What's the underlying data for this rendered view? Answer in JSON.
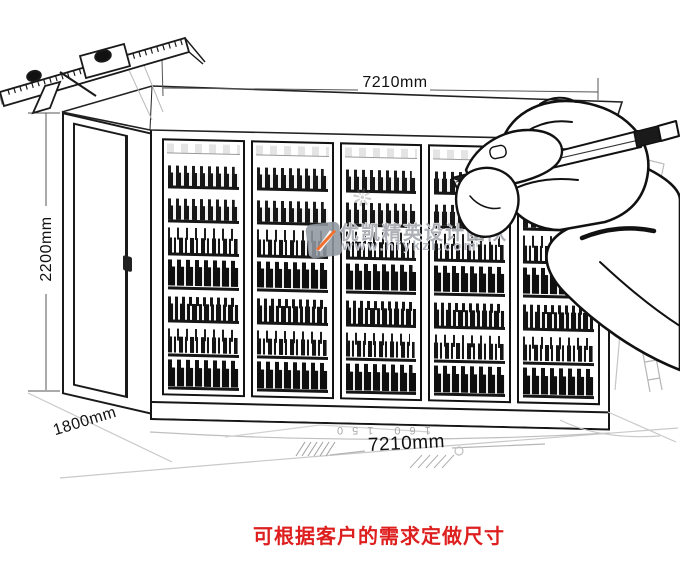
{
  "illustration": {
    "dimensions": {
      "top_width": "7210mm",
      "height": "2200mm",
      "depth": "1800mm",
      "bottom_width": "7210mm"
    },
    "floor_sketch_numbers": {
      "left": "160",
      "right": "150"
    },
    "cooler": {
      "door_count": 5,
      "shelf_rows_per_door": 7
    }
  },
  "note": {
    "text": "可根据客户的需求定做尺寸",
    "color": "#de1f1f"
  },
  "watermark": {
    "brand": "优凯精英设计团队",
    "url": "www.hfykzl.com",
    "sparkle_glyph": "❊",
    "logo_color": "#8f97a0",
    "accent_color": "#f07030"
  }
}
